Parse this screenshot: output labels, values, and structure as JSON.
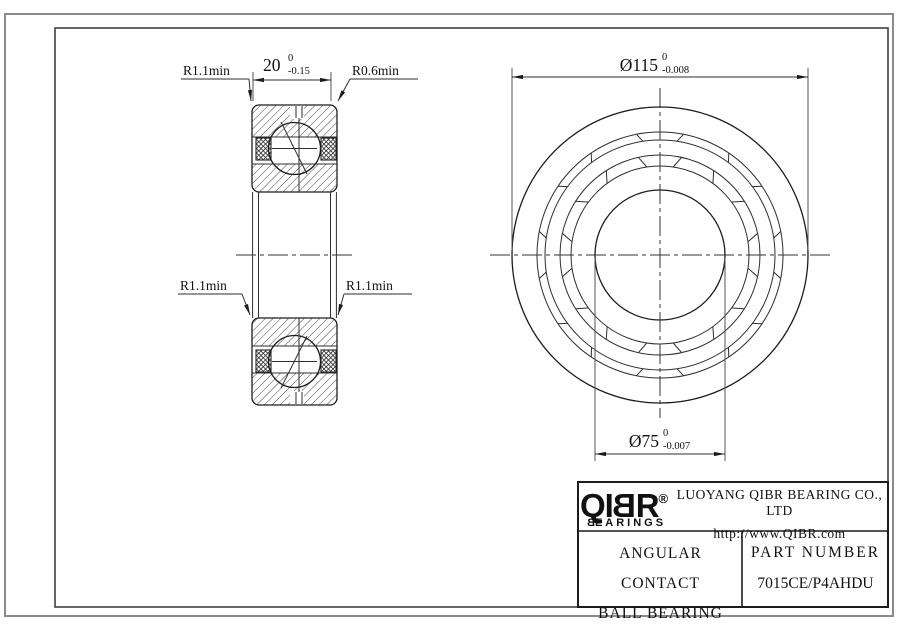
{
  "drawing_title": "Angular contact ball bearing engineering drawing",
  "dimensions": {
    "width_value": "20",
    "width_tol_upper": "0",
    "width_tol_lower": "-0.15",
    "od_value": "Ø115",
    "od_tol_upper": "0",
    "od_tol_lower": "-0.008",
    "bore_value": "Ø75",
    "bore_tol_upper": "0",
    "bore_tol_lower": "-0.007",
    "radius_top_left": "R1.1min",
    "radius_top_right": "R0.6min",
    "radius_bottom_left": "R1.1min",
    "radius_bottom_right": "R1.1min"
  },
  "title_block": {
    "logo_prefix": "QI",
    "logo_b": "B",
    "logo_suffix": "R",
    "registered": "®",
    "logo_sub_b": "B",
    "logo_sub_rest": "EARINGS",
    "company": "LUOYANG QIBR BEARING CO., LTD",
    "website": "http://www.QIBR.com",
    "product_line1": "ANGULAR CONTACT",
    "product_line2": "BALL BEARING",
    "part_label": "PART NUMBER",
    "part_number": "7015CE/P4AHDU"
  },
  "colors": {
    "line": "#1c1c1c",
    "outer_border": "#8a8a8a",
    "background": "#ffffff"
  }
}
